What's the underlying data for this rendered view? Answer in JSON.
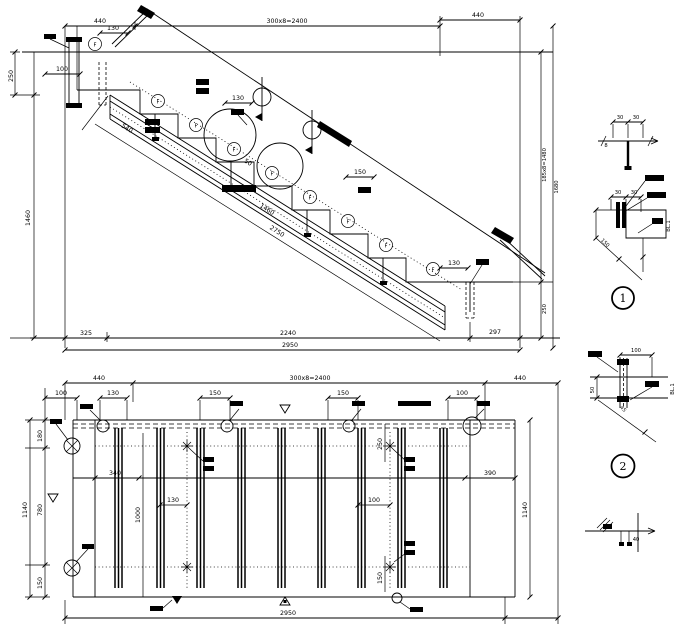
{
  "drawing_type": "stair-construction-drawing",
  "elevation": {
    "dim_top_left": "440",
    "dim_top_center": "300x8=2400",
    "dim_top_right": "440",
    "dim_left_250": "250",
    "dim_left_100": "100",
    "dim_left_1460": "1460",
    "dim_130_a": "130",
    "dim_130_b": "130",
    "dim_150_a": "150",
    "dim_130_c": "130",
    "dim_diag_540": "540",
    "dim_diag_50": "50",
    "dim_diag_1460": "1460",
    "dim_diag_2750": "2750",
    "dim_right_risers": "185x8=1480",
    "dim_right_1680": "1680",
    "dim_right_250": "250",
    "dim_bot_325": "325",
    "dim_bot_2240": "2240",
    "dim_bot_297": "297",
    "dim_bot_2950": "2950",
    "mark_f": "F"
  },
  "plan": {
    "dim_top_left": "440",
    "dim_top_center": "300x8=2400",
    "dim_top_right": "440",
    "sub_100_a": "100",
    "sub_130": "130",
    "sub_150_a": "150",
    "sub_150_b": "150",
    "sub_100_b": "100",
    "left_180": "180",
    "left_1140": "1140",
    "left_780": "780",
    "left_150": "150",
    "in_340": "340",
    "in_1000": "1000",
    "in_130": "130",
    "in_250": "250",
    "in_100": "100",
    "in_150": "150",
    "right_390": "390",
    "right_1140": "1140",
    "dim_bottom": "2950"
  },
  "details": {
    "one": {
      "label": "1",
      "d30a": "30",
      "d30b": "30",
      "d30c": "30",
      "d30d": "30",
      "t8": "8",
      "d150": "150",
      "bl": "BL.1"
    },
    "two": {
      "label": "2",
      "d100": "100",
      "d50": "50",
      "d45": "45",
      "bl": "BL.1"
    },
    "three": {
      "d40": "40"
    }
  },
  "colors": {
    "ink": "#000000",
    "paper": "#ffffff"
  }
}
